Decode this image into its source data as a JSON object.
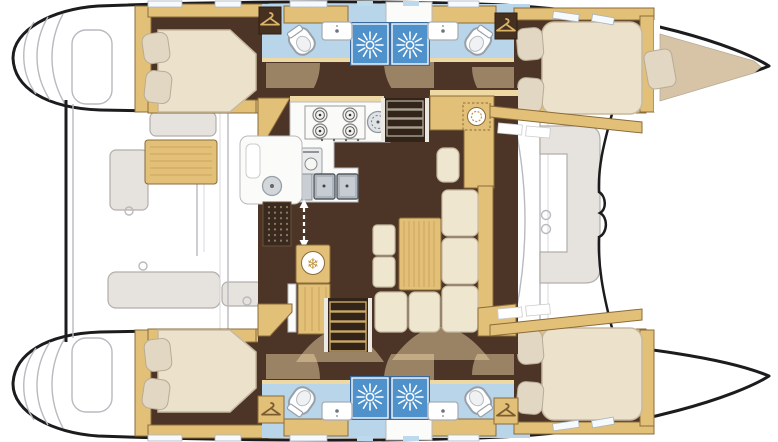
{
  "diagram": {
    "type": "catamaran-yacht-interior-floor-plan",
    "view": "top-down deck plan, bow to the right",
    "areas": {
      "hulls": [
        "upper hull",
        "lower hull"
      ],
      "cabins": [
        "aft double cabin upper hull",
        "forward double cabin upper hull",
        "aft double cabin lower hull",
        "forward double cabin lower hull",
        "forepeak berth upper bow"
      ],
      "heads": [
        "aft head with shower upper hull",
        "forward head with shower upper hull",
        "aft head with shower lower hull",
        "forward head with shower lower hull"
      ],
      "saloon": [
        "galley with 4-burner stove, round sink, oven and double sink",
        "refrigerator",
        "chart table with seat",
        "L-shaped settee with wood table and two stools",
        "companionway stairs to each hull",
        "sliding-door entry with mat"
      ],
      "exterior": [
        "aft cockpit with table and benches",
        "forward cockpit bench",
        "transom steps on both hulls"
      ]
    }
  },
  "icons": {
    "shower_icon": "sunburst",
    "fridge_icon": "snowflake-in-circle",
    "snowflake_glyph": "❄",
    "wardrobe_icon": "clothes-hanger",
    "entry_icon": "double-headed-dashed-arrow",
    "stove_icon": "four-burners"
  },
  "colors": {
    "hull_outline": "#1c1c1e",
    "line_art": "#b9b9bf",
    "line_art_light": "#d8d8dc",
    "bench_fill": "#e6e2de",
    "bench_stroke": "#b2aeaa",
    "wood": "#e3c078",
    "wood_dark": "#8a6b3a",
    "wood_light": "#eed9a4",
    "wood_grain": "#caa55e",
    "floor_dark": "#4c3527",
    "arc_overlay": "#e7d2a4",
    "mattress": "#ece1cb",
    "mattress_stroke": "#c6b99f",
    "pillow": "#e2d7c3",
    "pillow_stroke": "#b8ac96",
    "berth_cushion": "#d7c3a6",
    "bath_floor": "#b9d5ea",
    "shower_fill": "#4f92cb",
    "shower_frame": "#3a6a9d",
    "locker_dark": "#46301f",
    "hanger_tan": "#d9b36a",
    "hanger_brown": "#7a5c33",
    "snowflake": "#c19544",
    "skylight": "#bcd9ee",
    "white_counter": "#fbfbf9",
    "stair_dark": "#33241a",
    "tread_gray": "#a89f92",
    "tread_tan": "#c9a868"
  }
}
